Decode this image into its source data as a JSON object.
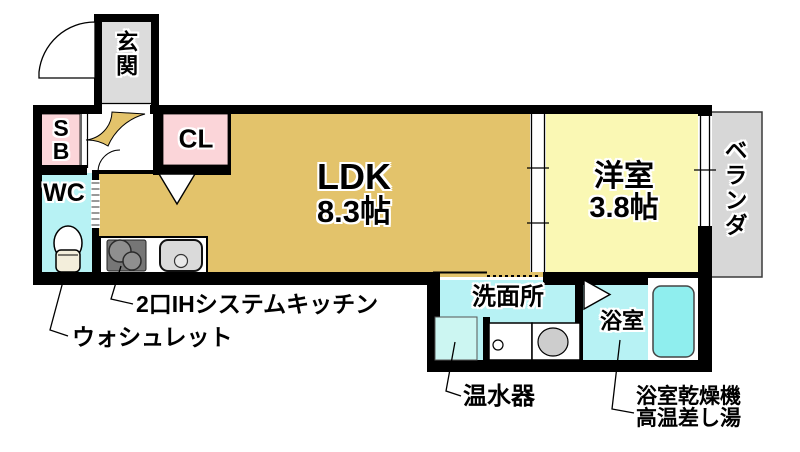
{
  "rooms": {
    "genkan": {
      "label": "玄関"
    },
    "shoe_box": {
      "label": "SB"
    },
    "closet": {
      "label": "CL"
    },
    "wc": {
      "label": "WC"
    },
    "ldk": {
      "label": "LDK",
      "size": "8.3帖"
    },
    "western_room": {
      "label": "洋室",
      "size": "3.8帖"
    },
    "veranda": {
      "label": "ベランダ"
    },
    "washroom": {
      "label": "洗面所"
    },
    "bathroom": {
      "label": "浴室"
    }
  },
  "annotations": {
    "washlet": {
      "label": "ウォシュレット"
    },
    "kitchen": {
      "label": "2口IHシステムキッチン"
    },
    "water_heater": {
      "label": "温水器"
    },
    "bath_features": {
      "line1": "浴室乾燥機",
      "line2": "高温差し湯"
    }
  },
  "colors": {
    "wall": "#000000",
    "ldk_floor_tan": "#e3c36b",
    "closet_pink": "#fbd5d9",
    "western_room_yellow": "#faf8b4",
    "wet_area_cyan": "#b7f2f4",
    "water_heater_cyan": "#ccf6f2",
    "bathtub_cyan": "#8feeee",
    "genkan_gray": "#dcdcdc",
    "veranda_gray": "#d7d7d7",
    "stove_gray": "#767676"
  }
}
